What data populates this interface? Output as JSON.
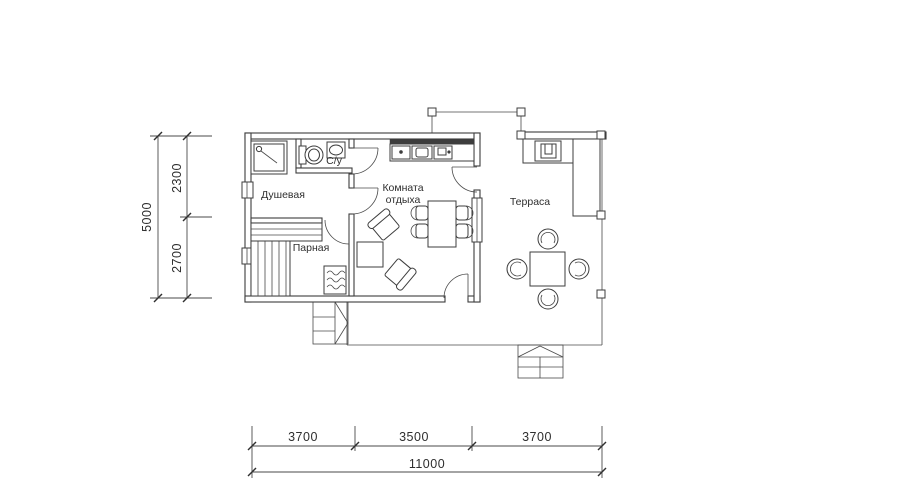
{
  "rooms": {
    "shower": {
      "label": "Душевая"
    },
    "wc": {
      "label": "С/у"
    },
    "steam": {
      "label": "Парная"
    },
    "lounge": {
      "label_line1": "Комната",
      "label_line2": "отдыха"
    },
    "terrace": {
      "label": "Терраса"
    }
  },
  "dimensions": {
    "vertical": {
      "total": "5000",
      "top": "2300",
      "bottom": "2700"
    },
    "horizontal": {
      "left": "3700",
      "middle": "3500",
      "right": "3700",
      "total": "11000"
    }
  },
  "colors": {
    "line": "#3d3d3d",
    "dimension_line": "#4a4a4a",
    "text": "#2e2e2e",
    "background": "#ffffff"
  },
  "icons": {
    "shower_cabin": "shower-cabin-icon",
    "toilet": "toilet-icon",
    "sink": "sink-icon",
    "sauna_stove": "sauna-stove-icon",
    "benches": "sauna-bench-icon",
    "kitchen_counter": "kitchen-counter-icon",
    "dining_table": "dining-table-icon",
    "armchair": "armchair-icon",
    "coffee_table": "coffee-table-icon",
    "terrace_table": "terrace-table-icon",
    "terrace_chair": "terrace-chair-icon",
    "grill": "grill-icon",
    "steps": "steps-icon"
  }
}
